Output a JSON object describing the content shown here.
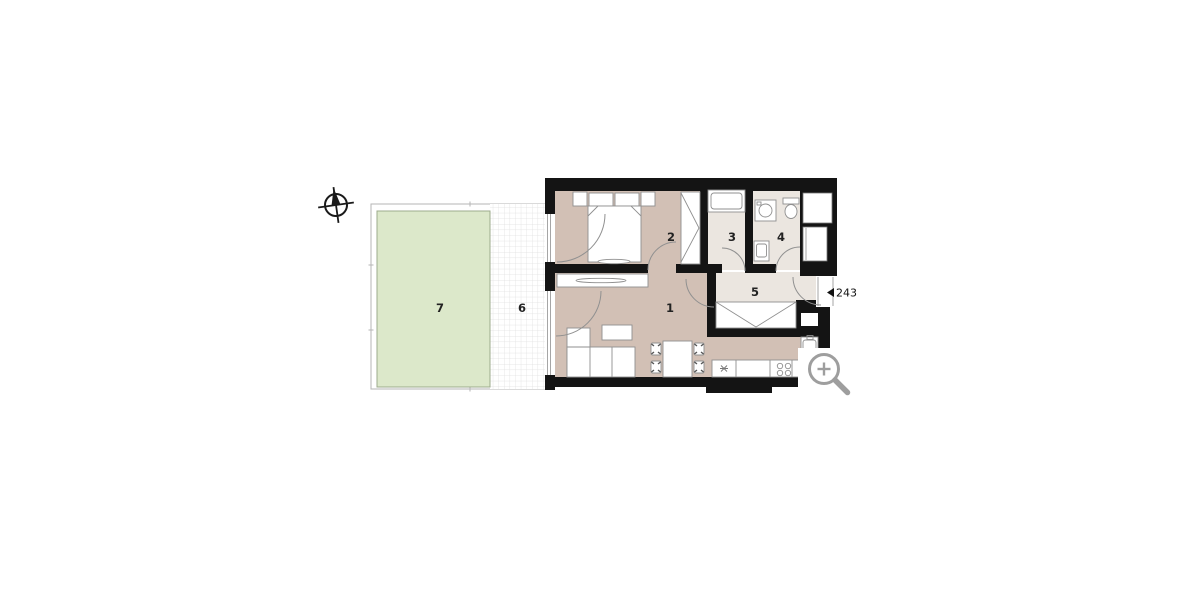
{
  "rooms": [
    {
      "id": "living-room",
      "label": "1"
    },
    {
      "id": "bedroom",
      "label": "2"
    },
    {
      "id": "bathroom",
      "label": "3"
    },
    {
      "id": "wc-utility",
      "label": "4"
    },
    {
      "id": "hallway",
      "label": "5"
    },
    {
      "id": "terrace",
      "label": "6"
    },
    {
      "id": "garden",
      "label": "7"
    }
  ],
  "entrance": {
    "unit_number": "243",
    "marker": "left-pointing-triangle"
  },
  "icons": {
    "compass": "north-arrow-compass",
    "magnifier": "zoom-in-magnifier"
  },
  "colors": {
    "wall": "#141414",
    "floor_warm": "#d2c0b5",
    "floor_light": "#ebe6e0",
    "garden": "#dce8ca",
    "grid_line": "#dedede",
    "magnifier": "#9e9e9e",
    "label": "#222222"
  }
}
